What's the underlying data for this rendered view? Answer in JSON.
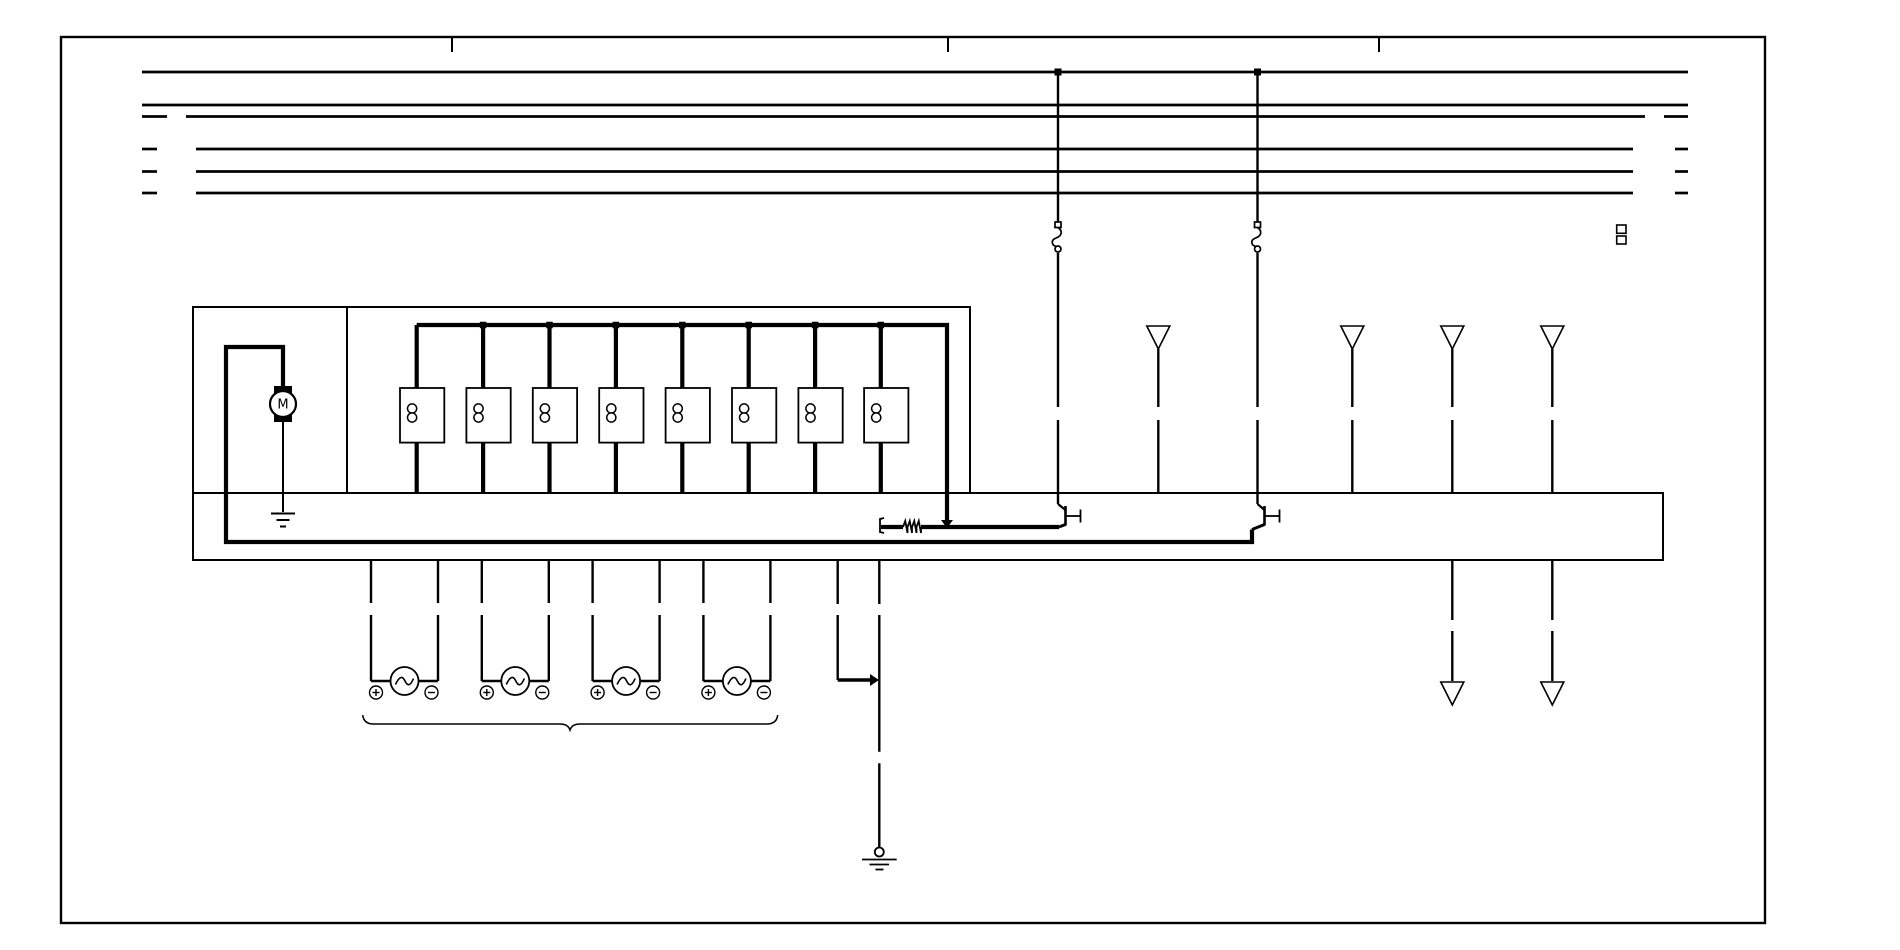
{
  "canvas": {
    "width": 1900,
    "height": 950,
    "background": "#ffffff",
    "ink": "#000000"
  },
  "frame": {
    "rect": [
      61,
      37,
      1704,
      886
    ],
    "stroke": 2.4,
    "ticks": {
      "xs": [
        452,
        948,
        1379
      ],
      "y1": 37,
      "y2": 52,
      "stroke": 2
    }
  },
  "bus": {
    "stroke": 2.7,
    "lines": [
      {
        "y": 72,
        "segments": [
          [
            142,
            1688
          ]
        ]
      },
      {
        "y": 105,
        "segments": [
          [
            142,
            1688
          ]
        ]
      },
      {
        "y": 116.5,
        "segments": [
          [
            142,
            167
          ],
          [
            186,
            1645
          ],
          [
            1664,
            1688
          ]
        ]
      },
      {
        "y": 149,
        "segments": [
          [
            142,
            157
          ],
          [
            196,
            1633
          ],
          [
            1675,
            1688
          ]
        ]
      },
      {
        "y": 171.5,
        "segments": [
          [
            142,
            157
          ],
          [
            196,
            1633
          ],
          [
            1675,
            1688
          ]
        ]
      },
      {
        "y": 193,
        "segments": [
          [
            142,
            157
          ],
          [
            196,
            1633
          ],
          [
            1675,
            1688
          ]
        ]
      }
    ],
    "taps": [
      {
        "x": 1058,
        "y": 72
      },
      {
        "x": 1257.5,
        "y": 72
      }
    ],
    "tap_size": 7
  },
  "boxes": {
    "rects": [
      {
        "name": "relay-unit-box",
        "x": 193,
        "y": 307,
        "w": 777,
        "h": 186
      },
      {
        "name": "control-unit-strip",
        "x": 193,
        "y": 493,
        "w": 1470,
        "h": 67
      }
    ],
    "lines": [
      {
        "name": "unit-divider",
        "x1": 347,
        "y1": 307,
        "x2": 347,
        "y2": 493
      }
    ],
    "stroke": 2
  },
  "wires": {
    "stroke": 2.4,
    "runs": [
      {
        "name": "fuse1-wire",
        "x": 1058,
        "segments": [
          [
            72,
            222
          ],
          [
            253,
            407
          ],
          [
            420,
            504
          ]
        ]
      },
      {
        "name": "fuse2-wire",
        "x": 1257.5,
        "segments": [
          [
            72,
            222
          ],
          [
            253,
            407
          ],
          [
            420,
            504
          ]
        ]
      },
      {
        "name": "shield1-wire",
        "x": 1158.3,
        "segments": [
          [
            349,
            407
          ],
          [
            420,
            493
          ]
        ]
      },
      {
        "name": "shield2-wire",
        "x": 1352.3,
        "segments": [
          [
            349,
            407
          ],
          [
            420,
            493
          ]
        ]
      },
      {
        "name": "shield3-wire",
        "x": 1452.3,
        "segments": [
          [
            349,
            407
          ],
          [
            420,
            493
          ]
        ]
      },
      {
        "name": "shield4-wire",
        "x": 1552.3,
        "segments": [
          [
            349,
            407
          ],
          [
            420,
            493
          ]
        ]
      },
      {
        "name": "output1-wire",
        "x": 1452.3,
        "segments": [
          [
            560,
            620
          ],
          [
            631,
            681
          ]
        ]
      },
      {
        "name": "output2-wire",
        "x": 1552.3,
        "segments": [
          [
            560,
            620
          ],
          [
            631,
            681
          ]
        ]
      }
    ]
  },
  "thick": {
    "stroke": 4.2,
    "polylines": [
      {
        "name": "motor-feed-and-ground-bus",
        "points": [
          [
            283,
            389
          ],
          [
            283,
            347
          ],
          [
            226,
            347
          ],
          [
            226,
            542
          ],
          [
            1252,
            542
          ],
          [
            1252,
            529.5
          ]
        ]
      },
      {
        "name": "relay-supply-bus",
        "points": [
          [
            416.7,
            325
          ],
          [
            947,
            325
          ],
          [
            947,
            521
          ]
        ]
      },
      {
        "name": "resistor-wire-left",
        "points": [
          [
            881,
            527
          ],
          [
            903,
            527
          ]
        ]
      },
      {
        "name": "resistor-wire-right",
        "points": [
          [
            921,
            527
          ],
          [
            1059,
            527
          ]
        ]
      }
    ]
  },
  "relays": {
    "xs": [
      416.7,
      483.1,
      549.5,
      615.9,
      682.3,
      748.7,
      815.1,
      880.8
    ],
    "wire_top": 325,
    "wire_bottom": 493,
    "wire_stroke": 4.2,
    "dot_size": 6.5,
    "box": {
      "dx": -16.7,
      "y": 388,
      "w": 44.3,
      "h": 54.6,
      "stroke": 1.8
    },
    "coil": {
      "r": 4.6,
      "cy1": 408.5,
      "cy2": 417.5,
      "dx": -4.6,
      "stroke": 1.5
    }
  },
  "resistor": {
    "zig": {
      "x1": 903,
      "x2": 921,
      "y": 527,
      "amp": 6,
      "n": 4,
      "stroke": 1.8
    },
    "terminal": {
      "x": 880,
      "y1": 518,
      "y2": 533,
      "stroke": 1.8
    }
  },
  "junctions": {
    "size": 6,
    "items": [
      {
        "type": "down",
        "x": 947,
        "y": 526
      },
      {
        "type": "right",
        "x": 877,
        "y": 680
      }
    ]
  },
  "transistors": {
    "stroke": 2.2,
    "items": [
      {
        "in": [
          1058,
          504
        ],
        "bar_x": 1065.5,
        "bar_y1": 506,
        "bar_y2": 525.5,
        "stub_x2": 1080.5,
        "stub_y": 516,
        "out": [
          1059,
          527
        ]
      },
      {
        "in": [
          1257.5,
          504
        ],
        "bar_x": 1264.5,
        "bar_y1": 506,
        "bar_y2": 525.5,
        "stub_x2": 1279.5,
        "stub_y": 516,
        "out": [
          1252,
          529.5
        ]
      }
    ]
  },
  "fuses": {
    "stroke": 1.7,
    "items": [
      {
        "x": 1058,
        "y": 222
      },
      {
        "x": 1257.5,
        "y": 222
      }
    ]
  },
  "triangles": {
    "stroke": 1.6,
    "half_w": 11.5,
    "height": 23,
    "items": [
      {
        "name": "shield-arrow-top-1",
        "x": 1158.3,
        "top": 326
      },
      {
        "name": "shield-arrow-top-2",
        "x": 1352.3,
        "top": 326
      },
      {
        "name": "shield-arrow-top-3",
        "x": 1452.3,
        "top": 326
      },
      {
        "name": "shield-arrow-top-4",
        "x": 1552.3,
        "top": 326
      },
      {
        "name": "shield-arrow-bottom-1",
        "x": 1452.3,
        "top": 682
      },
      {
        "name": "shield-arrow-bottom-2",
        "x": 1552.3,
        "top": 682
      }
    ]
  },
  "motor": {
    "label": "M",
    "cx": 283,
    "cy": 404,
    "r": 13,
    "stroke": 2.2,
    "font_size": 13,
    "brush": {
      "w": 18,
      "h": 8,
      "top_y": 386,
      "bottom_y": 414
    },
    "tail": {
      "y1": 421,
      "y2": 512,
      "stroke": 2
    },
    "ground": {
      "bars": [
        [
          271,
          295,
          513.5
        ],
        [
          276.5,
          289.5,
          520
        ],
        [
          280,
          286,
          526.5
        ]
      ],
      "stroke": 2
    }
  },
  "injectors": {
    "stroke": 2.4,
    "centers": [
      404.5,
      515.3,
      626.1,
      736.9
    ],
    "dx": 33.5,
    "stub": {
      "y1": 560,
      "y2": 603
    },
    "lower": {
      "y1": 615,
      "y2": 681
    },
    "circle": {
      "cy": 681,
      "r": 14,
      "stroke": 1.8
    },
    "sine_stroke": 1.6,
    "terminal": {
      "r": 6.5,
      "cy": 692.5,
      "plus_dx": 5,
      "minus_dx": 6.5,
      "stroke": 1.4
    },
    "brace": {
      "x1": 362.7,
      "x2": 777.7,
      "y": 717,
      "cx": 570,
      "dip": 730,
      "stroke": 1.5
    }
  },
  "ground_branch": {
    "stroke": 2.4,
    "xa": 837.7,
    "xb": 879.3,
    "a_segments": [
      [
        560,
        604
      ],
      [
        615,
        680
      ]
    ],
    "b_segments": [
      [
        560,
        604
      ],
      [
        615,
        751.7
      ],
      [
        763.3,
        848
      ]
    ],
    "link_y": 680,
    "link_stroke": 3.5,
    "chassis": {
      "ring_cy": 852,
      "ring_r": 4.5,
      "stroke": 1.8,
      "bars": [
        [
          862,
          896.7,
          859.5
        ],
        [
          869.5,
          889,
          864.5
        ],
        [
          875.5,
          883.5,
          869.5
        ]
      ]
    }
  },
  "extras": {
    "stroke": 1.6,
    "squares": [
      [
        1616.7,
        225,
        9.3,
        8.3
      ],
      [
        1616.7,
        236,
        9.3,
        8
      ]
    ]
  }
}
